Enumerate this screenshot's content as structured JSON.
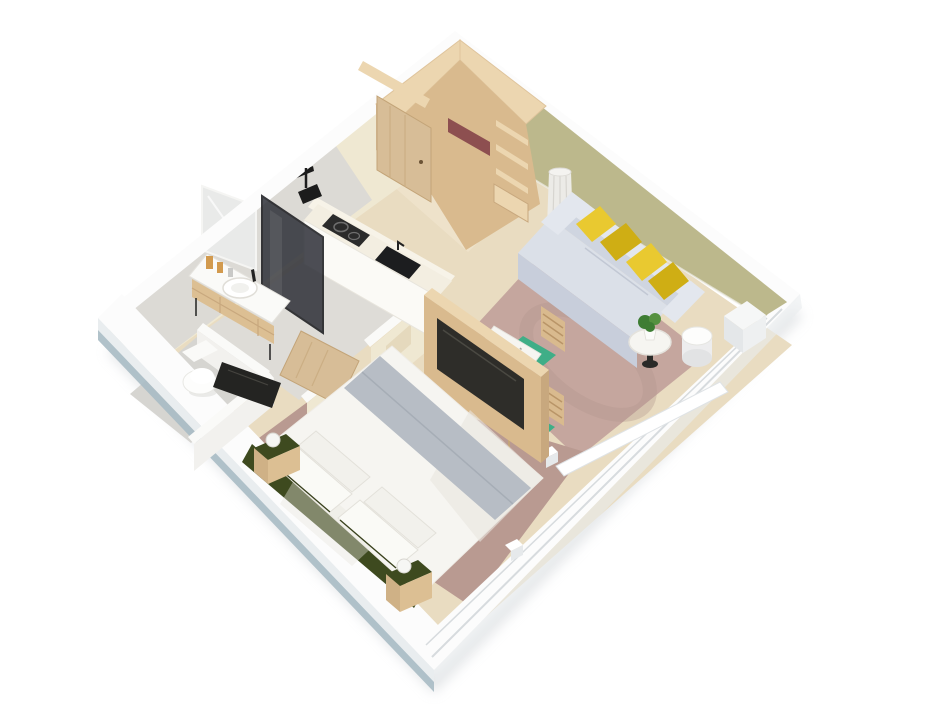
{
  "scene": {
    "type": "3d-isometric-floor-plan",
    "description": "3D cutaway render of a one-bedroom apartment, rotated 45 degrees on a white background",
    "rooms": {
      "entry_hall": {
        "objects": [
          "open wooden entry door",
          "corner wardrobe with shelves",
          "maroon towels",
          "wood floor"
        ]
      },
      "kitchen": {
        "objects": [
          "cream counter",
          "black two-burner cooktop",
          "black inset sink"
        ]
      },
      "living_room": {
        "objects": [
          "olive green accent wall",
          "gray sofa",
          "four yellow cushions",
          "round coffee table with plant",
          "round white drum side table",
          "tall white floor vase",
          "dining table with terrazzo top",
          "two wood chairs with green seats",
          "white radiator box",
          "mauve rug",
          "low window wall with sills"
        ]
      },
      "bedroom": {
        "objects": [
          "double bed with white duvet",
          "gray throw blanket",
          "four white pillows",
          "dark green headboard",
          "two wood nightstands with green tops",
          "two white ball lamps",
          "mauve rug",
          "wood TV partition wall with black TV"
        ]
      },
      "bathroom": {
        "objects": [
          "white vanity with wood shelf",
          "wall mirror",
          "amber candles",
          "dark glass shower screen",
          "black shower head",
          "black track light",
          "gray tile floor",
          "open wood door"
        ]
      },
      "wc": {
        "objects": [
          "white toilet",
          "half-height partition walls",
          "black wall TV"
        ]
      }
    }
  },
  "palette": {
    "bg": "#ffffff",
    "shadow": "#c9ced2",
    "floor_wood": "#e9dcc1",
    "floor_wood_light": "#f2e8d1",
    "floor_bath": "#dedcd7",
    "floor_wc": "#d6d5d1",
    "rug_living": "#c5a69e",
    "rug_living_line": "#b3958d",
    "rug_bedroom": "#b99a91",
    "band_white": "#fcfcfc",
    "outer_face": "#e9edef",
    "outer_edge": "#a9bbc4",
    "groove": "#d7dbde",
    "sill": "#ffffff",
    "wall_cream": "#efe8d2",
    "wall_cream_light": "#f7f3e8",
    "wall_gray": "#dcdad5",
    "wall_olive": "#bcb88c",
    "wall_white_top": "#fafaf8",
    "pony_white": "#f2f1ee",
    "niche": "#e5d9bd",
    "mirror": "#e9eae9",
    "black": "#1c1c1c",
    "glass": "#2e3038",
    "wood_light": "#ecd6b0",
    "wood_mid": "#d9ba8e",
    "wood_dark": "#c8a87e",
    "wood_door": "#d7bd97",
    "towel": "#8d4f50",
    "counter_top": "#f3eee1",
    "counter_front": "#fbfaf6",
    "appliance": "#2b2b2b",
    "sink": "#1c1d1f",
    "sofa_top": "#e3e7ee",
    "sofa_inner": "#cfd5e0",
    "sofa_seat": "#dbe0e8",
    "sofa_front": "#c8cedb",
    "pillow": "#e9c930",
    "pillow_dark": "#cfae14",
    "table_white": "#f6f5f1",
    "chair_green": "#3fae87",
    "fixture_white": "#fafaf8",
    "fixture_bright": "#fdfdfc",
    "fixture_shadow": "#d8d8d4",
    "bed_white": "#f6f5f1",
    "bed_shade": "#e9e6df",
    "blanket": "#b7bdc5",
    "headboard": "#3e4a1f",
    "ns_wood": "#dcbf93",
    "ns_wood_dark": "#cfb186",
    "lamp": "#f6f6f4",
    "plant": "#3e7d33",
    "plant2": "#559140",
    "candle": "#d29a4e",
    "vase": "#ecebe7",
    "radiator": "#f6f7f7",
    "tv_dark": "#2e2d29",
    "tv_screen": "#242422"
  }
}
